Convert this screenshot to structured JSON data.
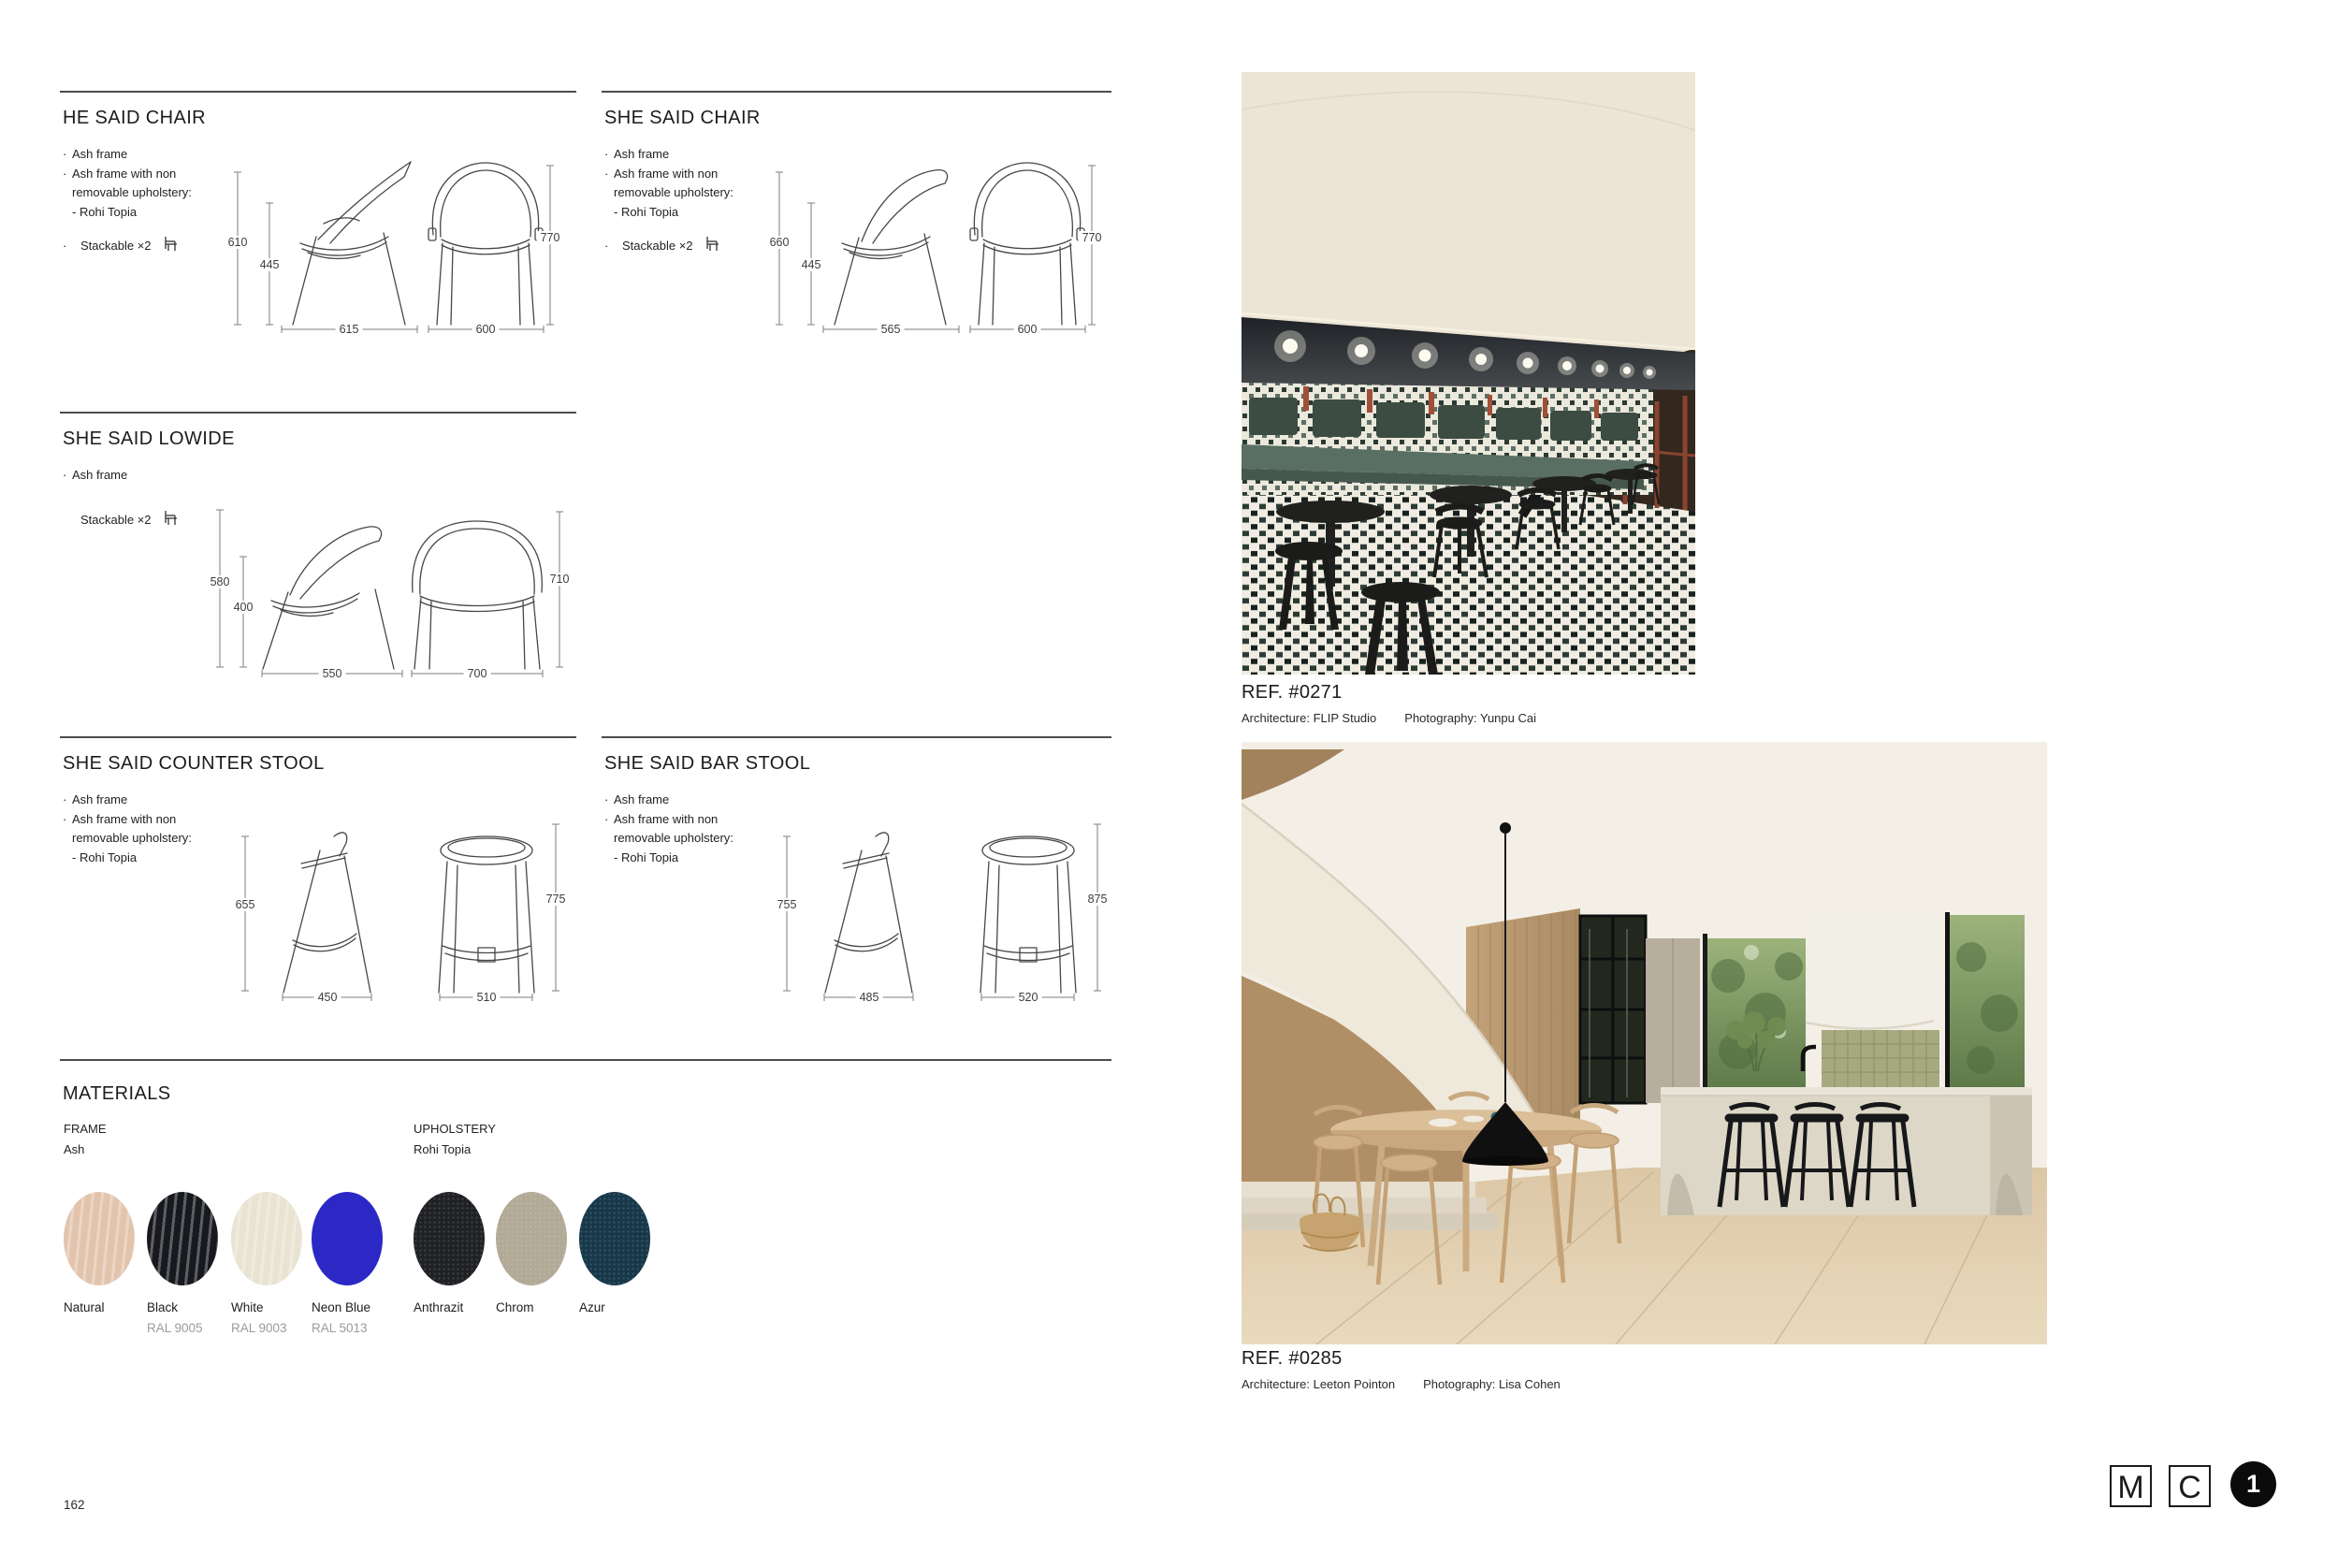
{
  "products": {
    "he_said_chair": {
      "title": "HE SAID CHAIR",
      "lines": [
        {
          "d": "·",
          "t": "Ash frame"
        },
        {
          "d": "·",
          "t": "Ash frame with non"
        },
        {
          "d": "",
          "t": "removable upholstery:"
        },
        {
          "d": "",
          "t": "- Rohi Topia"
        }
      ],
      "stackable": {
        "d": "·",
        "t": "Stackable ×2"
      },
      "dims": {
        "side_h": "610",
        "seat_h": "445",
        "side_w": "615",
        "front_h": "770",
        "front_w": "600"
      }
    },
    "she_said_chair": {
      "title": "SHE SAID CHAIR",
      "lines": [
        {
          "d": "·",
          "t": "Ash frame"
        },
        {
          "d": "·",
          "t": "Ash frame with non"
        },
        {
          "d": "",
          "t": "removable upholstery:"
        },
        {
          "d": "",
          "t": "- Rohi Topia"
        }
      ],
      "stackable": {
        "d": "·",
        "t": "Stackable ×2"
      },
      "dims": {
        "side_h": "660",
        "seat_h": "445",
        "side_w": "565",
        "front_h": "770",
        "front_w": "600"
      }
    },
    "she_said_lowide": {
      "title": "SHE SAID LOWIDE",
      "lines": [
        {
          "d": "·",
          "t": "Ash frame"
        }
      ],
      "stackable": {
        "d": "",
        "t": "Stackable ×2"
      },
      "dims": {
        "side_h": "580",
        "seat_h": "400",
        "side_w": "550",
        "front_h": "710",
        "front_w": "700"
      }
    },
    "she_said_counter_stool": {
      "title": "SHE SAID COUNTER STOOL",
      "lines": [
        {
          "d": "·",
          "t": "Ash frame"
        },
        {
          "d": "·",
          "t": "Ash frame with non"
        },
        {
          "d": "",
          "t": "removable upholstery:"
        },
        {
          "d": "",
          "t": "- Rohi Topia"
        }
      ],
      "dims": {
        "side_h": "655",
        "side_w": "450",
        "front_h": "775",
        "front_w": "510"
      }
    },
    "she_said_bar_stool": {
      "title": "SHE SAID BAR STOOL",
      "lines": [
        {
          "d": "·",
          "t": "Ash frame"
        },
        {
          "d": "·",
          "t": "Ash frame with non"
        },
        {
          "d": "",
          "t": "removable upholstery:"
        },
        {
          "d": "",
          "t": "- Rohi Topia"
        }
      ],
      "dims": {
        "side_h": "755",
        "side_w": "485",
        "front_h": "875",
        "front_w": "520"
      }
    }
  },
  "materials": {
    "title": "MATERIALS",
    "frame": {
      "label": "FRAME",
      "sub": "Ash",
      "swatches": [
        {
          "name": "Natural",
          "ral": "",
          "color": "#e2c4ad"
        },
        {
          "name": "Black",
          "ral": "RAL 9005",
          "color": "#17191e"
        },
        {
          "name": "White",
          "ral": "RAL 9003",
          "color": "#e9e3d2"
        },
        {
          "name": "Neon Blue",
          "ral": "RAL 5013",
          "color": "#2b28c6"
        }
      ]
    },
    "upholstery": {
      "label": "UPHOLSTERY",
      "sub": "Rohi Topia",
      "swatches": [
        {
          "name": "Anthrazit",
          "ral": "",
          "color": "#1f2125"
        },
        {
          "name": "Chrom",
          "ral": "",
          "color": "#b2a996"
        },
        {
          "name": "Azur",
          "ral": "",
          "color": "#17384a"
        }
      ]
    }
  },
  "photos": [
    {
      "ref": "REF. #0271",
      "architecture": "Architecture: FLIP Studio",
      "photography": "Photography: Yunpu Cai"
    },
    {
      "ref": "REF. #0285",
      "architecture": "Architecture: Leeton Pointon",
      "photography": "Photography: Lisa Cohen"
    }
  ],
  "footer": {
    "page_number": "162",
    "logo_m": "M",
    "logo_c": "C",
    "badge": "1"
  }
}
